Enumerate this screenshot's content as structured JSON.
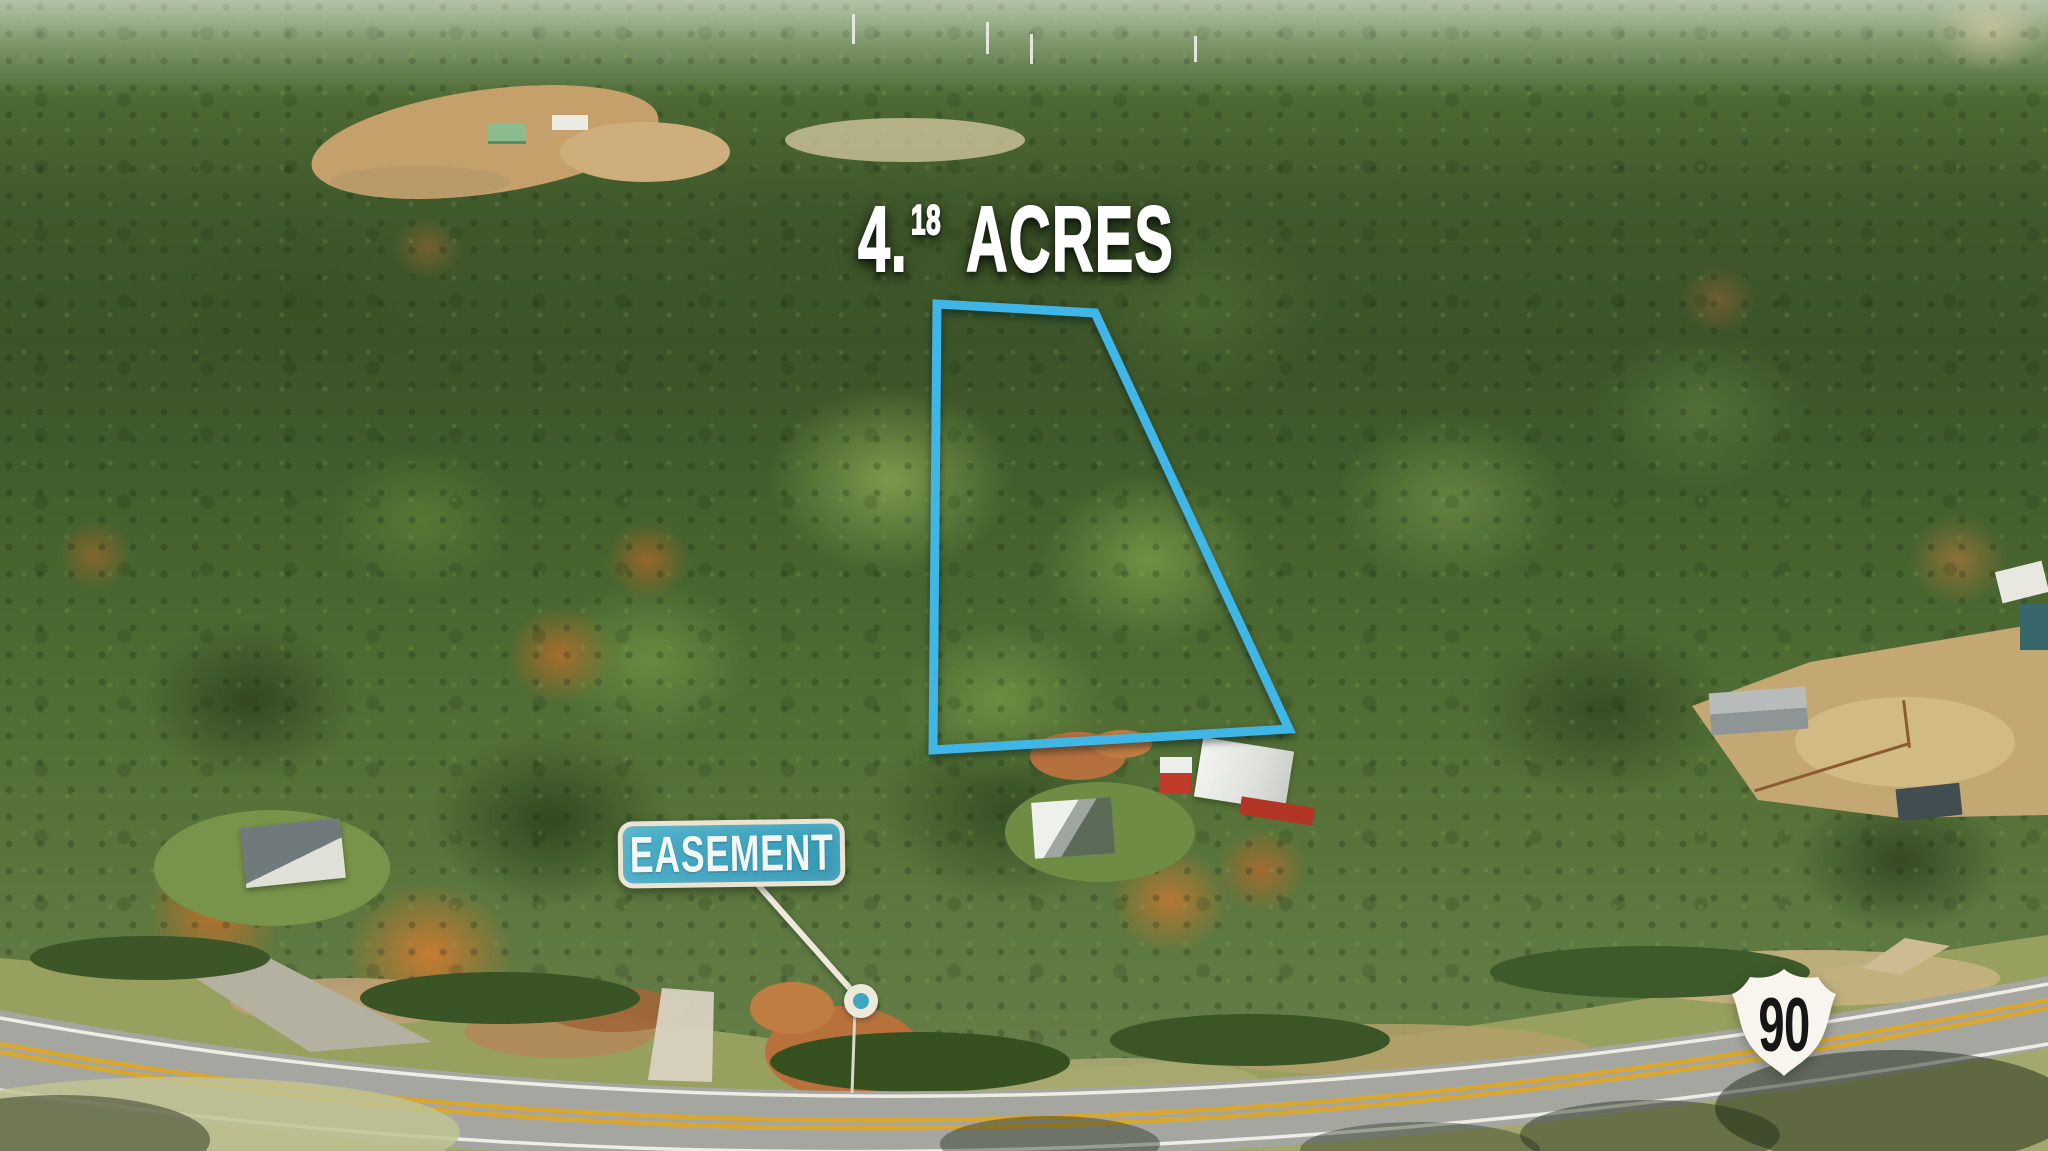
{
  "photo": {
    "acreage": {
      "number": "4.",
      "superscript": "18",
      "unit": "ACRES"
    },
    "easement": {
      "label": "EASEMENT"
    },
    "route_shield": {
      "number": "90",
      "fill": "#f7f5ee",
      "number_color": "#161616"
    },
    "boundary": {
      "points": "937,304 1095,313 1289,729 933,750",
      "color": "#40b6e6",
      "stroke_width": "9"
    },
    "pointer": {
      "line_points": "759,886 861,1001",
      "line_color": "#ece9db",
      "cx": "861",
      "cy": "1001",
      "r_outer": "17",
      "r_inner": "8",
      "inner_color": "#3fa6c0"
    },
    "accent_colors": {
      "boundary_cyan": "#40b6e6",
      "badge_teal": "#3fa3be",
      "badge_border_cream": "#e9e4d4",
      "road_yellow": "#d9a62e",
      "title_white": "#ffffff"
    }
  }
}
